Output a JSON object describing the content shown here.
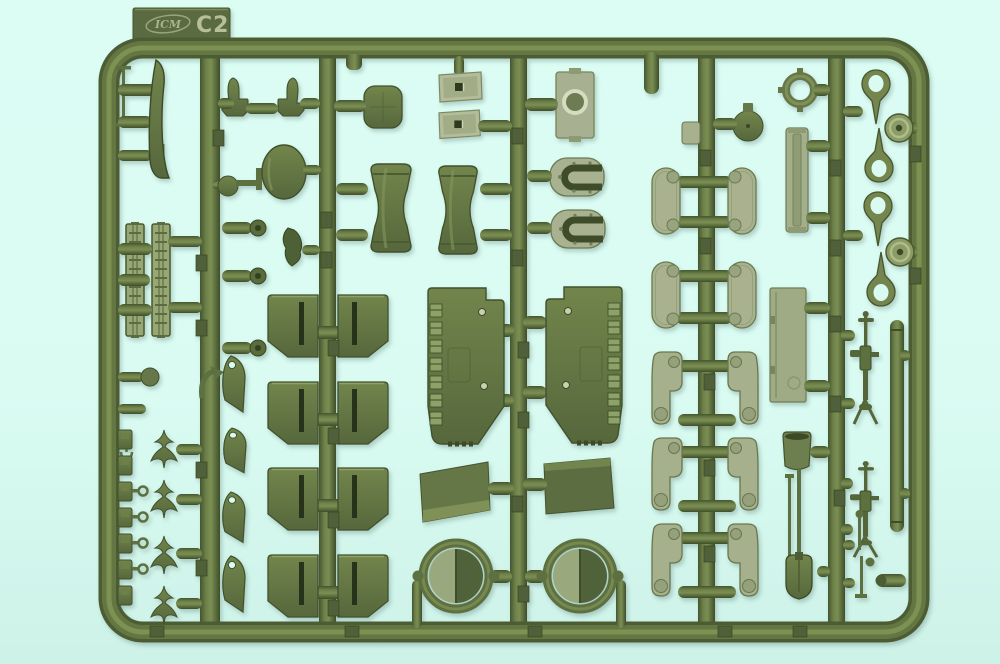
{
  "scene": {
    "description": "Photograph of an olive-green injection-moulded plastic model-kit sprue (parts tree / runner frame) full of vehicle detail parts, lying on a pale mint background",
    "background_color": "#d9fbf2"
  },
  "label": {
    "brand": "ICM",
    "sprue_code": "C2"
  },
  "palette": {
    "background": "#d9fbf2",
    "plastic_dark": "#44552e",
    "plastic_base": "#5f7244",
    "plastic_light": "#8ba065",
    "plastic_pale": "#a7b18e"
  },
  "parts_inventory": [
    {
      "name": "radiator grille",
      "count": 2
    },
    {
      "name": "mudflap plate, slotted",
      "count": 8
    },
    {
      "name": "hood side panel with louvres",
      "count": 2
    },
    {
      "name": "rolled tarpaulin drum",
      "count": 2
    },
    {
      "name": "hatch plate with square opening",
      "count": 2
    },
    {
      "name": "mount block with round opening",
      "count": 1
    },
    {
      "name": "U-shaped clamp",
      "count": 2
    },
    {
      "name": "towing shackle",
      "count": 4
    },
    {
      "name": "pulley wheel",
      "count": 2
    },
    {
      "name": "suspension link, oval",
      "count": 4
    },
    {
      "name": "suspension link, stepped",
      "count": 6
    },
    {
      "name": "anchor-shaped bracket",
      "count": 4
    },
    {
      "name": "blade fin with hole",
      "count": 4
    },
    {
      "name": "eyelet fitting",
      "count": 7
    },
    {
      "name": "windscreen panel",
      "count": 2
    },
    {
      "name": "headlamp ring with bucket",
      "count": 2
    },
    {
      "name": "machine gun",
      "count": 2
    },
    {
      "name": "exhaust pipe",
      "count": 1
    },
    {
      "name": "flat mounting bar",
      "count": 1
    },
    {
      "name": "stowage panel",
      "count": 1
    },
    {
      "name": "towing ring",
      "count": 1
    },
    {
      "name": "shovel",
      "count": 1
    },
    {
      "name": "bucket",
      "count": 1
    },
    {
      "name": "fender profile",
      "count": 1
    },
    {
      "name": "assorted plugs and pegs",
      "count": 14
    }
  ]
}
